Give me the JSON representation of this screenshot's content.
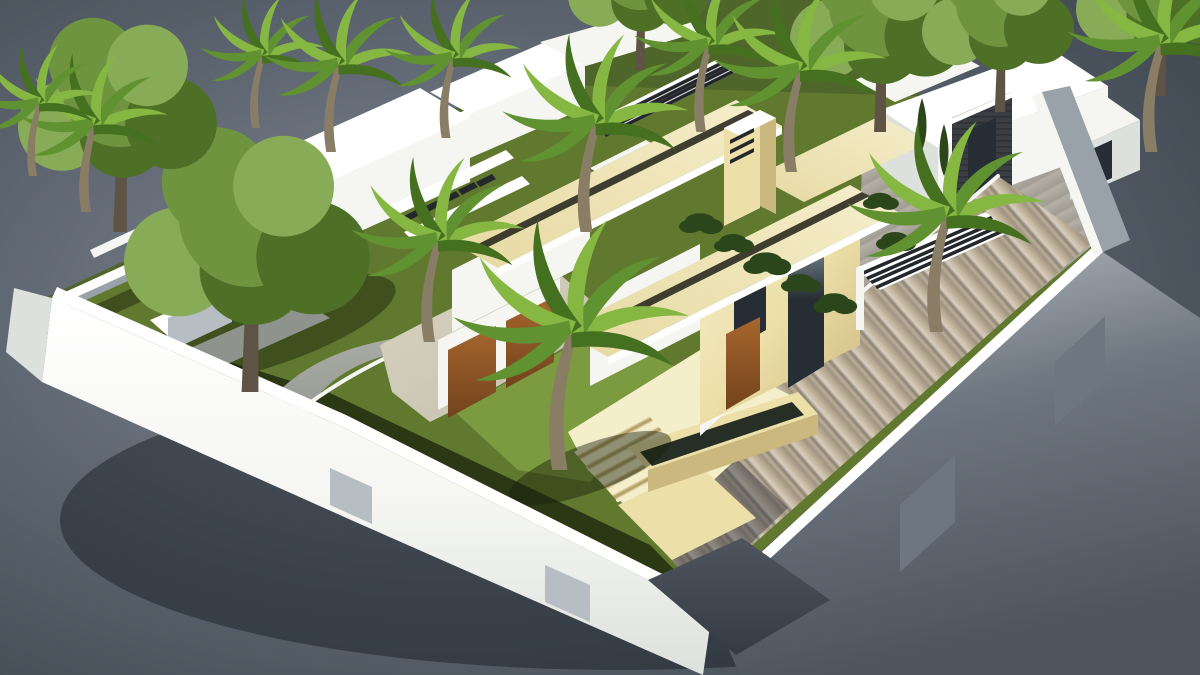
{
  "image": {
    "type": "3d-architectural-render",
    "subject": "aerial axonometric rendering of a modern luxury villa plot with garden, driveway and neighboring houses",
    "width": 1200,
    "height": 675,
    "visible_text": "none"
  },
  "colors": {
    "bg_center": "#848b96",
    "bg_mid": "#5b636e",
    "bg_edge": "#3d454f",
    "wall_top": "#ffffff",
    "wall_lit": "#f5f6f2",
    "wall_shade": "#dde1dd",
    "wall_gray": "#b7bec3",
    "wall_inner": "#9aa2a9",
    "wall_dark": "#6e7681",
    "grass": "#61792f",
    "grass_light": "#7c9a3f",
    "grass_shade": "#3d5220",
    "grass_dark": "#2a3814",
    "neighbor_grass": "#4f662a",
    "stone_wall": "#ecdfa8",
    "stone_light": "#f5eecb",
    "roof_beige": "#e6d9a2",
    "stone_shade": "#cbb87e",
    "stone_dark": "#ab9a62",
    "forecourt": "#d9d3c2",
    "forecourt_dark": "#c3bdab",
    "path_gray": "#a8aca4",
    "path_dark": "#8e938d",
    "drive_a": "#d8cebd",
    "drive_b": "#bcae97",
    "drive_c": "#9f9483",
    "drive_d": "#8a8275",
    "court_a": "#b4b0a7",
    "court_b": "#a19d94",
    "apron": "#4e555f",
    "apron_dark": "#343b44",
    "wood": "#a8662e",
    "wood_dark": "#71431c",
    "glass": "#262d34",
    "glass_light": "#7e8c95",
    "pool": "#74c4c0",
    "palm_a": "#85b742",
    "palm_b": "#609231",
    "palm_c": "#44701f",
    "leaf_a": "#6f9440",
    "leaf_b": "#4e7026",
    "leaf_c": "#88ab57",
    "trunk": "#8a7d66",
    "trunk_dark": "#5e5344",
    "shrub": "#2c461c",
    "clad": "#3a3e43",
    "clad_dark": "#24272b"
  },
  "scene": {
    "background": "studio gray radial gradient, darker at corners",
    "elements": [
      "white perimeter wall with gray inset panels",
      "main beige travertine villa with two parallel flat roof slabs and recessed skylight channels",
      "roof chimney with vent slats",
      "two tall glass facade windows and wood entry door",
      "two wood garage doors with stone forecourt",
      "white pergola with dark slats behind villa",
      "small pool on rear terrace",
      "front lawn with large curved palm tree",
      "big side lawn with large deciduous tree",
      "curved gray garden path with white curb",
      "beige steps and raised dark water trough",
      "striped stone paver driveway exiting through gate with dark ramp",
      "gray paver courtyard with white slatted carport pergola",
      "neighbor house top-left: white modern volumes with stair bridge",
      "neighbor house top-right: white volumes with dark stone-clad tower",
      "entry gate structure with two glass panels at left corner",
      "rows of palm trees and dark green shrubs along boundaries"
    ]
  }
}
